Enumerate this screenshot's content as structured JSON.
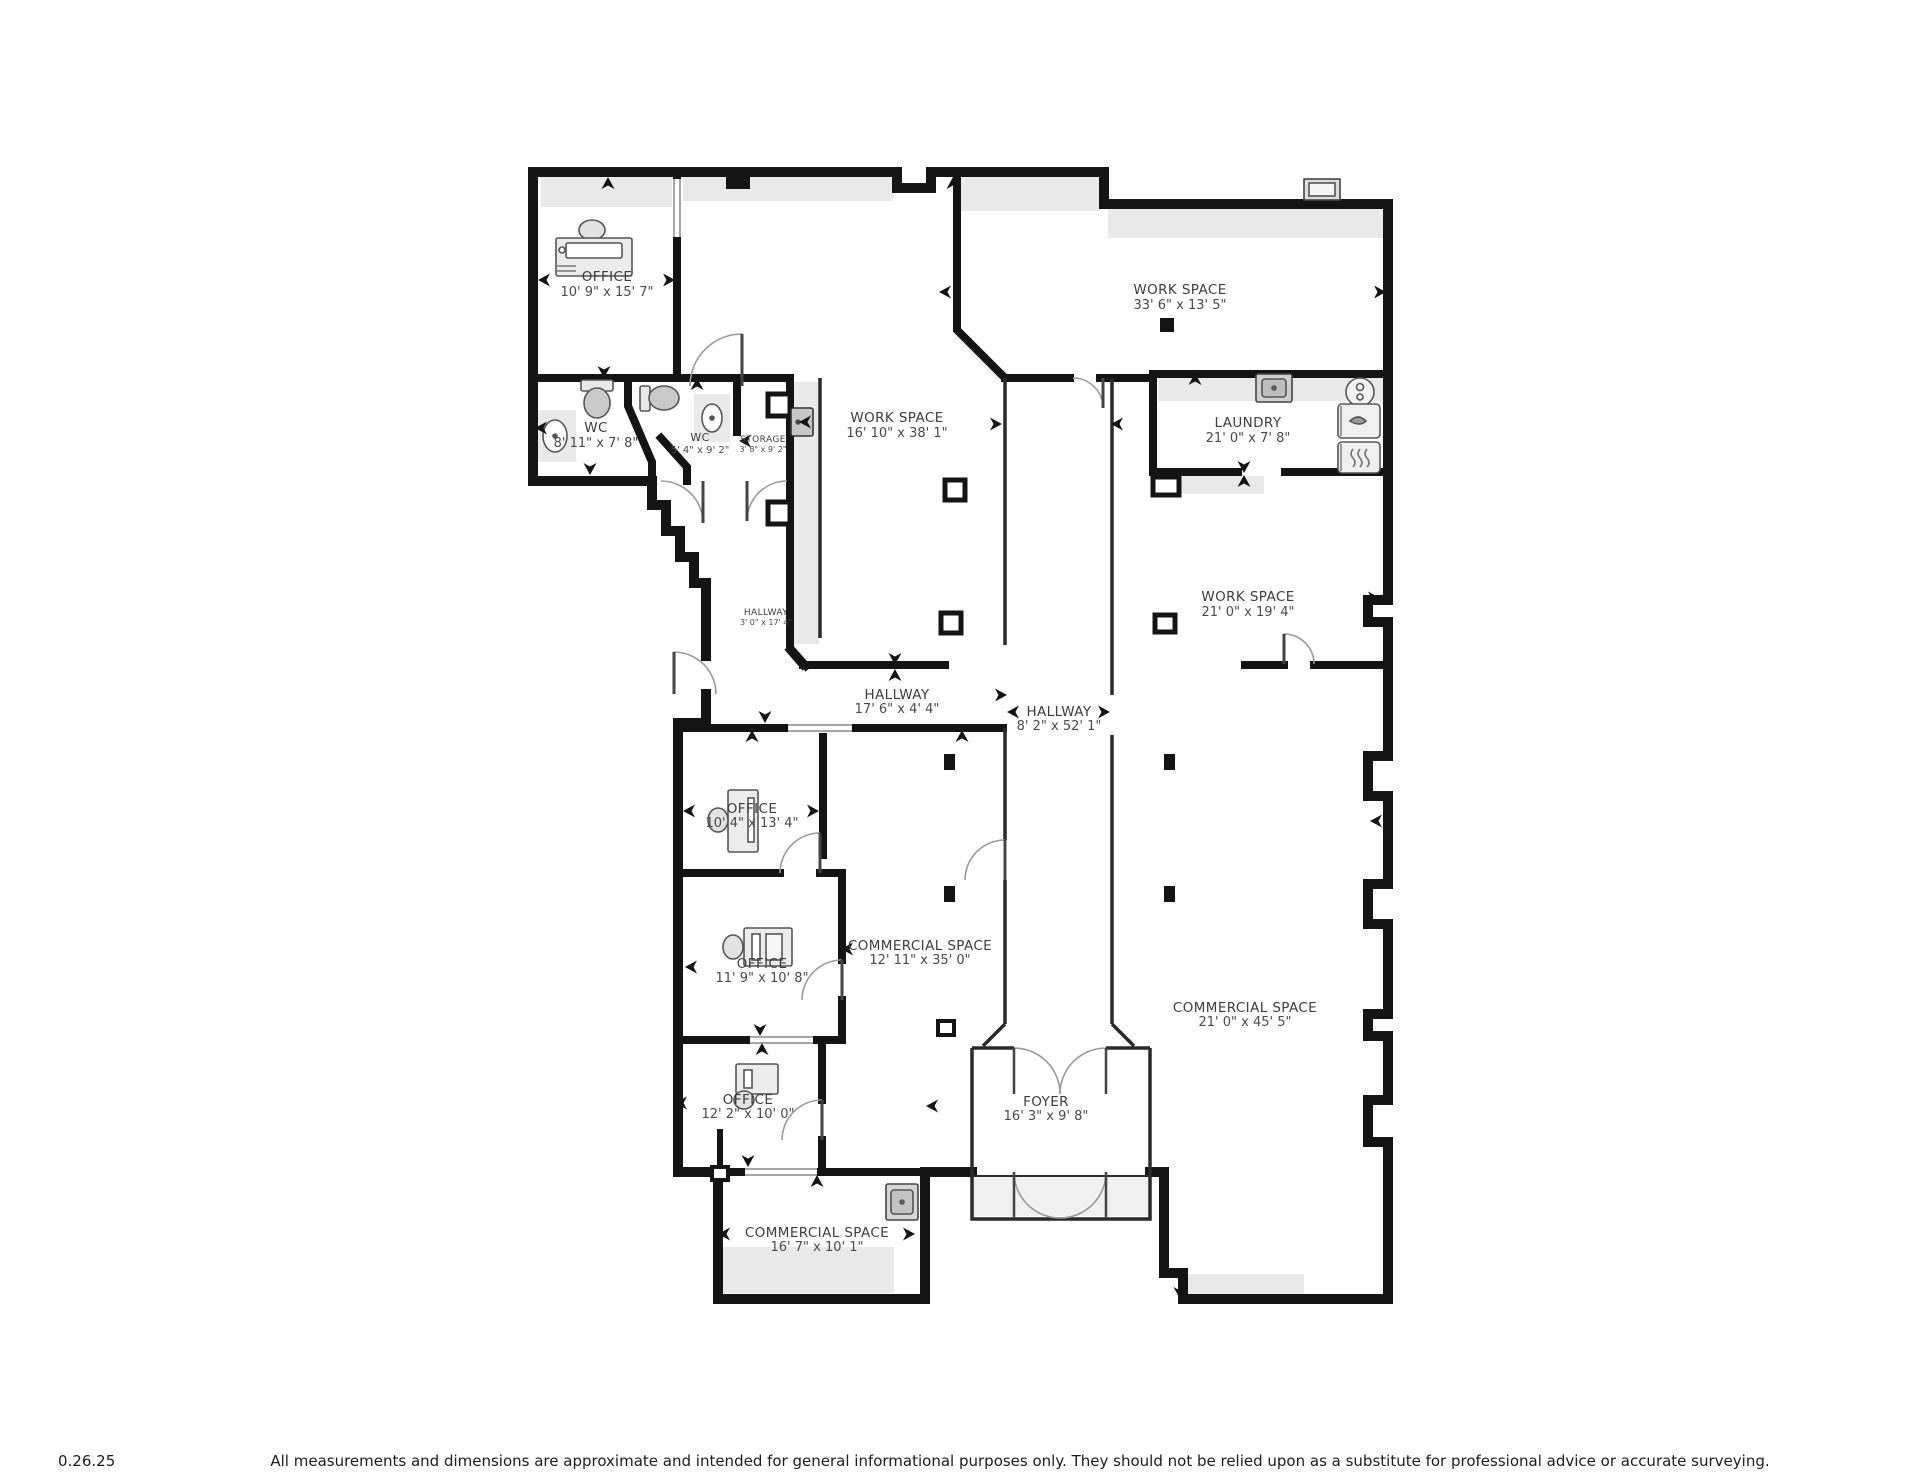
{
  "rooms": {
    "office_top": {
      "name": "OFFICE",
      "dims": "10' 9\" x 15' 7\""
    },
    "work_space_top": {
      "name": "WORK SPACE",
      "dims": "33' 6\" x 13' 5\""
    },
    "wc_large": {
      "name": "WC",
      "dims": "8' 11\" x 7' 8\""
    },
    "wc_small": {
      "name": "WC",
      "dims": "5' 4\" x 9' 2\""
    },
    "storage": {
      "name": "STORAGE",
      "dims": "3' 8\" x 9' 2\""
    },
    "work_space_mid": {
      "name": "WORK SPACE",
      "dims": "16' 10\" x 38' 1\""
    },
    "laundry": {
      "name": "LAUNDRY",
      "dims": "21' 0\" x 7' 8\""
    },
    "work_space_right": {
      "name": "WORK SPACE",
      "dims": "21' 0\" x 19' 4\""
    },
    "hallway_small": {
      "name": "HALLWAY",
      "dims": "3' 0\" x 17' 4\""
    },
    "hallway_mid": {
      "name": "HALLWAY",
      "dims": "17' 6\" x 4' 4\""
    },
    "hallway_long": {
      "name": "HALLWAY",
      "dims": "8' 2\" x 52' 1\""
    },
    "office_1": {
      "name": "OFFICE",
      "dims": "10' 4\" x 13' 4\""
    },
    "office_2": {
      "name": "OFFICE",
      "dims": "11' 9\" x 10' 8\""
    },
    "office_3": {
      "name": "OFFICE",
      "dims": "12' 2\" x 10' 0\""
    },
    "commercial_mid": {
      "name": "COMMERCIAL SPACE",
      "dims": "12' 11\" x 35' 0\""
    },
    "commercial_right": {
      "name": "COMMERCIAL SPACE",
      "dims": "21' 0\" x 45' 5\""
    },
    "commercial_bottom": {
      "name": "COMMERCIAL SPACE",
      "dims": "16' 7\" x 10' 1\""
    },
    "foyer": {
      "name": "FOYER",
      "dims": "16' 3\" x 9' 8\""
    }
  },
  "footer": {
    "version": "0.26.25",
    "disclaimer": "All measurements and dimensions are approximate and intended for general informational purposes only. They should not be relied upon as a substitute for professional advice or accurate surveying."
  },
  "colors": {
    "wall": "#141414",
    "floor_strip": "#e9e9e9",
    "fixture_fill": "#d9d9d9",
    "label_text": "#3d3d3d"
  }
}
